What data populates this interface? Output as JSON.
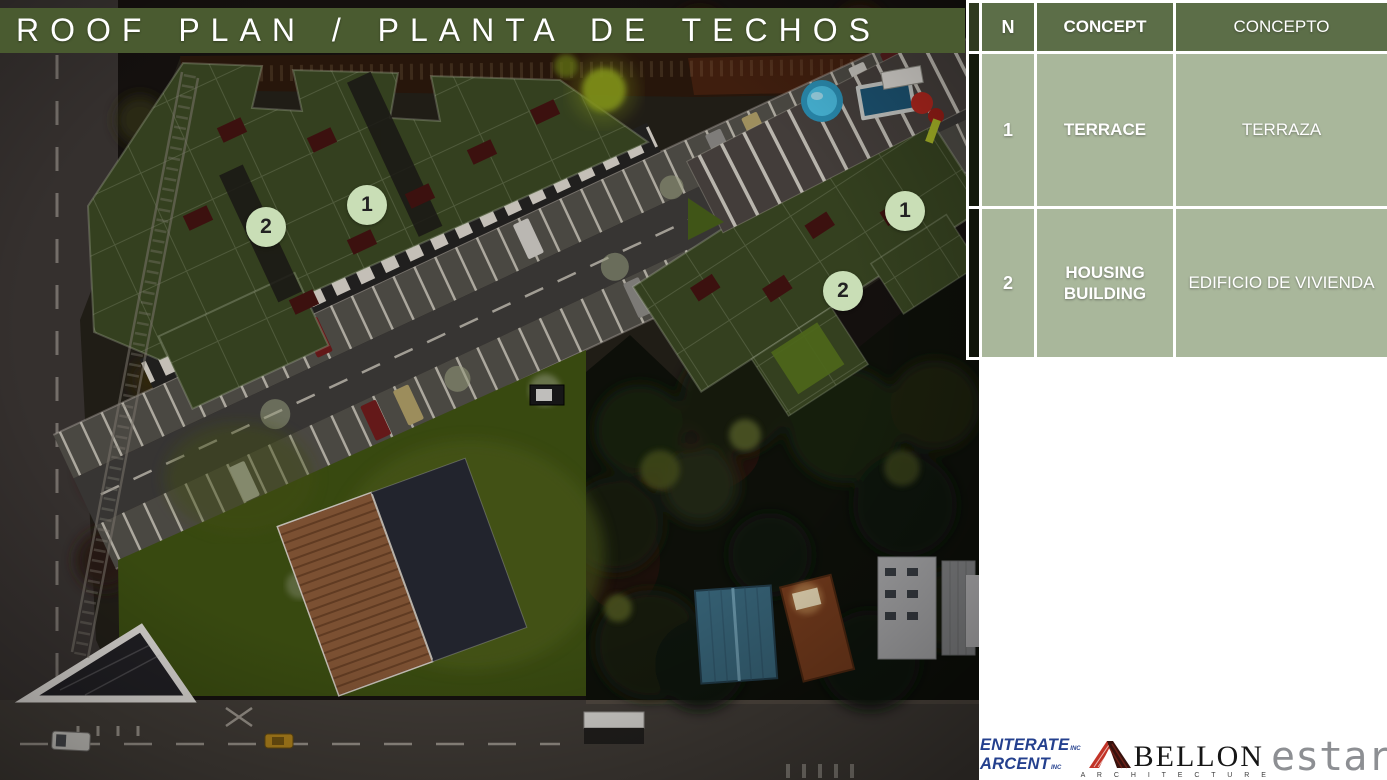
{
  "slide": {
    "title": "ROOF PLAN / PLANTA DE TECHOS"
  },
  "legend": {
    "headers": {
      "n": "N",
      "concept": "CONCEPT",
      "concepto": "CONCEPTO"
    },
    "rows": [
      {
        "n": "1",
        "concept": "TERRACE",
        "concepto": "TERRAZA"
      },
      {
        "n": "2",
        "concept": "HOUSING BUILDING",
        "concepto": "EDIFICIO DE VIVIENDA"
      }
    ]
  },
  "plan_markers": [
    {
      "label": "2"
    },
    {
      "label": "1"
    },
    {
      "label": "1"
    },
    {
      "label": "2"
    }
  ],
  "footer_logos": {
    "enterate": {
      "line1": "ENTERATE",
      "line2": "ARCENT",
      "inc": "INC"
    },
    "bellon": {
      "name": "BELLON",
      "subtitle": "A R C H I T E C T U R E"
    },
    "estar": {
      "name": "estar"
    }
  },
  "colors": {
    "title_bar_green": "#4a5b30",
    "table_header_green": "#5c6e48",
    "table_cell_sage": "#a9b79b",
    "marker_fill": "#c9deb6",
    "enterate_blue": "#24408e",
    "bellon_red": "#c23327",
    "estar_gray": "#8d8f93"
  }
}
